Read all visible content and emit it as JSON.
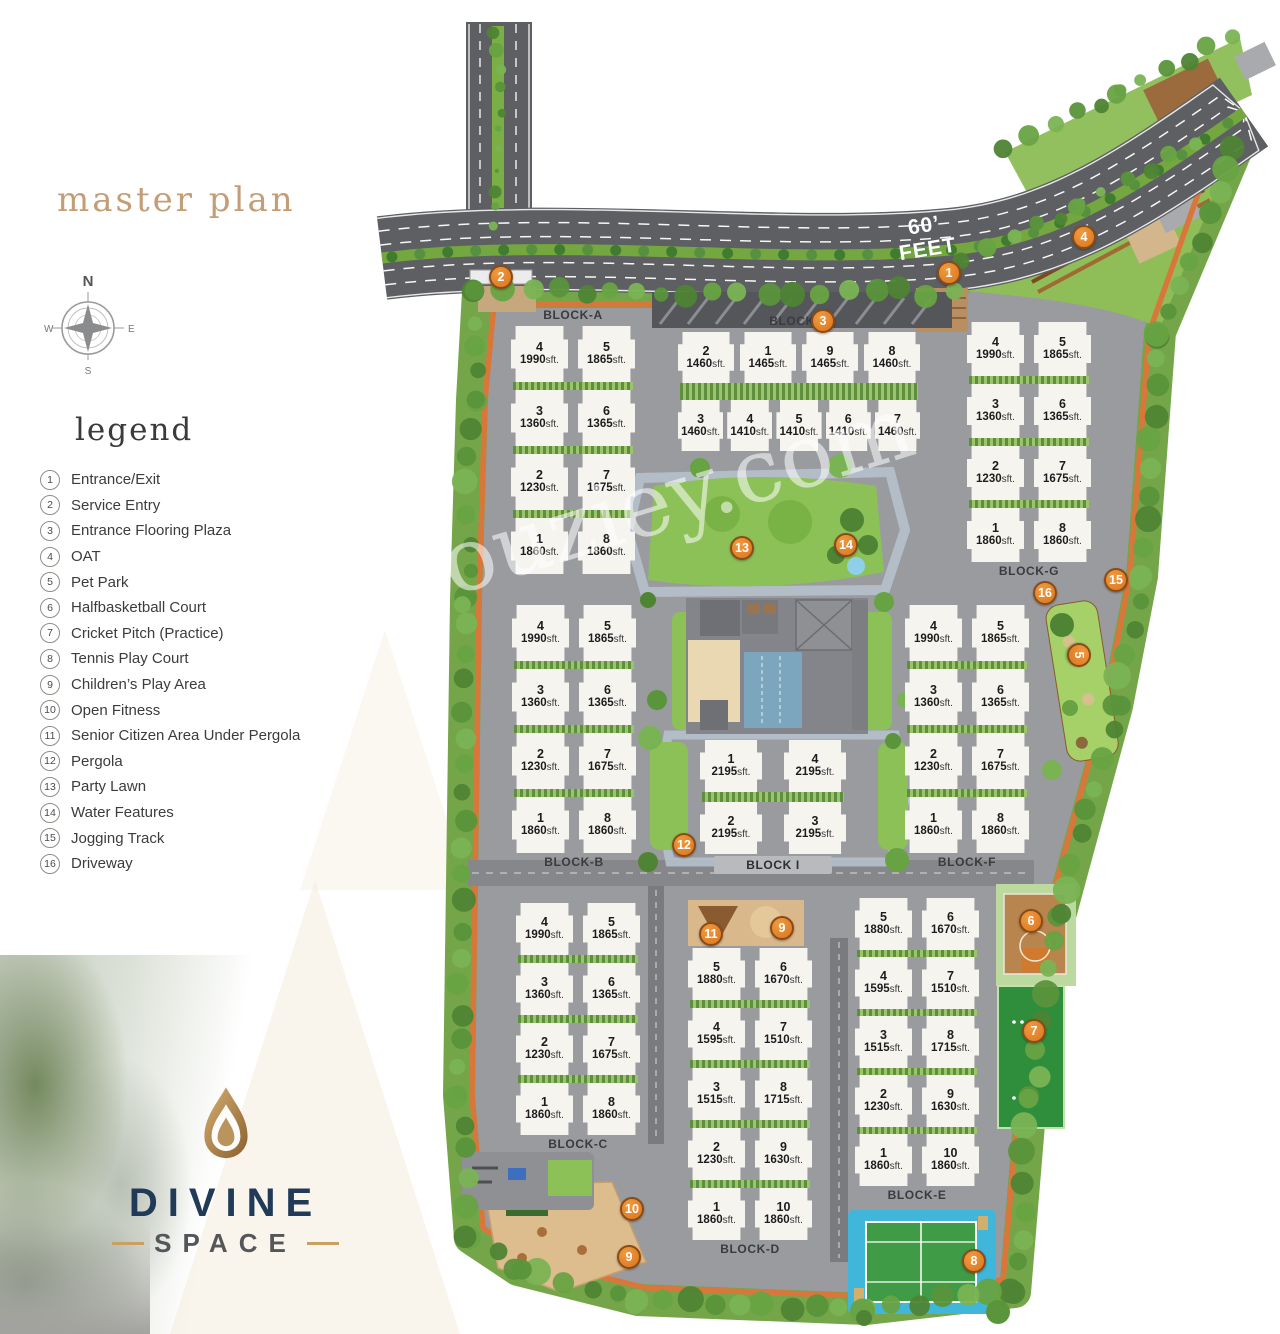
{
  "header": {
    "title": "master plan",
    "legend_title": "legend"
  },
  "compass": {
    "north": "N",
    "east": "E",
    "south": "S",
    "west": "W"
  },
  "legend": {
    "items": [
      {
        "num": "1",
        "label": "Entrance/Exit"
      },
      {
        "num": "2",
        "label": "Service Entry"
      },
      {
        "num": "3",
        "label": "Entrance Flooring Plaza"
      },
      {
        "num": "4",
        "label": "OAT"
      },
      {
        "num": "5",
        "label": "Pet Park"
      },
      {
        "num": "6",
        "label": "Halfbasketball Court"
      },
      {
        "num": "7",
        "label": "Cricket Pitch (Practice)"
      },
      {
        "num": "8",
        "label": "Tennis Play Court"
      },
      {
        "num": "9",
        "label": "Children’s Play Area"
      },
      {
        "num": "10",
        "label": "Open Fitness"
      },
      {
        "num": "11",
        "label": "Senior Citizen Area Under Pergola"
      },
      {
        "num": "12",
        "label": "Pergola"
      },
      {
        "num": "13",
        "label": "Party Lawn"
      },
      {
        "num": "14",
        "label": "Water Features"
      },
      {
        "num": "15",
        "label": "Jogging Track"
      },
      {
        "num": "16",
        "label": "Driveway"
      }
    ]
  },
  "road": {
    "width_label": "60’",
    "unit_label": "FEET"
  },
  "watermark": "Houziey.com",
  "logo": {
    "line1": "DIVINE",
    "line2": "SPACE"
  },
  "plan": {
    "size_suffix": "sft.",
    "blocks": [
      {
        "name": "BLOCK-A",
        "label_pos": "top",
        "x": 511,
        "y": 326,
        "unit_w": 57,
        "row_h": 56,
        "row_gap": 8,
        "col_gap": 10,
        "rows": [
          [
            {
              "no": "4",
              "size": "1990"
            },
            {
              "no": "5",
              "size": "1865"
            }
          ],
          [
            {
              "no": "3",
              "size": "1360"
            },
            {
              "no": "6",
              "size": "1365"
            }
          ],
          [
            {
              "no": "2",
              "size": "1230"
            },
            {
              "no": "7",
              "size": "1675"
            }
          ],
          [
            {
              "no": "1",
              "size": "1860"
            },
            {
              "no": "8",
              "size": "1860"
            }
          ]
        ]
      },
      {
        "name": "BLOCK-H",
        "label_pos": "top",
        "x": 678,
        "y": 332,
        "unit_w": 56,
        "row_h": 51,
        "row_gap": 17,
        "col_gap": 6,
        "unit_w_rows": [
          56,
          46
        ],
        "col_gaps": [
          6,
          4
        ],
        "rows": [
          [
            {
              "no": "2",
              "size": "1460"
            },
            {
              "no": "1",
              "size": "1465"
            },
            {
              "no": "9",
              "size": "1465"
            },
            {
              "no": "8",
              "size": "1460"
            }
          ],
          [
            {
              "no": "3",
              "size": "1460"
            },
            {
              "no": "4",
              "size": "1410"
            },
            {
              "no": "5",
              "size": "1410"
            },
            {
              "no": "6",
              "size": "1410"
            },
            {
              "no": "7",
              "size": "1460"
            }
          ]
        ]
      },
      {
        "name": "BLOCK-G",
        "label_pos": "bottom",
        "x": 967,
        "y": 322,
        "unit_w": 57,
        "row_h": 54,
        "row_gap": 8,
        "col_gap": 10,
        "rows": [
          [
            {
              "no": "4",
              "size": "1990"
            },
            {
              "no": "5",
              "size": "1865"
            }
          ],
          [
            {
              "no": "3",
              "size": "1360"
            },
            {
              "no": "6",
              "size": "1365"
            }
          ],
          [
            {
              "no": "2",
              "size": "1230"
            },
            {
              "no": "7",
              "size": "1675"
            }
          ],
          [
            {
              "no": "1",
              "size": "1860"
            },
            {
              "no": "8",
              "size": "1860"
            }
          ]
        ]
      },
      {
        "name": "BLOCK-B",
        "label_pos": "bottom",
        "x": 512,
        "y": 605,
        "unit_w": 57,
        "row_h": 56,
        "row_gap": 8,
        "col_gap": 10,
        "rows": [
          [
            {
              "no": "4",
              "size": "1990"
            },
            {
              "no": "5",
              "size": "1865"
            }
          ],
          [
            {
              "no": "3",
              "size": "1360"
            },
            {
              "no": "6",
              "size": "1365"
            }
          ],
          [
            {
              "no": "2",
              "size": "1230"
            },
            {
              "no": "7",
              "size": "1675"
            }
          ],
          [
            {
              "no": "1",
              "size": "1860"
            },
            {
              "no": "8",
              "size": "1860"
            }
          ]
        ]
      },
      {
        "name": "BLOCK-F",
        "label_pos": "bottom",
        "x": 905,
        "y": 605,
        "unit_w": 57,
        "row_h": 56,
        "row_gap": 8,
        "col_gap": 10,
        "rows": [
          [
            {
              "no": "4",
              "size": "1990"
            },
            {
              "no": "5",
              "size": "1865"
            }
          ],
          [
            {
              "no": "3",
              "size": "1360"
            },
            {
              "no": "6",
              "size": "1365"
            }
          ],
          [
            {
              "no": "2",
              "size": "1230"
            },
            {
              "no": "7",
              "size": "1675"
            }
          ],
          [
            {
              "no": "1",
              "size": "1860"
            },
            {
              "no": "8",
              "size": "1860"
            }
          ]
        ]
      },
      {
        "name": "BLOCK I",
        "label_pos": "bottom",
        "chip": true,
        "x": 700,
        "y": 740,
        "unit_w": 62,
        "row_h": 52,
        "row_gap": 10,
        "col_gap": 22,
        "rows": [
          [
            {
              "no": "1",
              "size": "2195"
            },
            {
              "no": "4",
              "size": "2195"
            }
          ],
          [
            {
              "no": "2",
              "size": "2195"
            },
            {
              "no": "3",
              "size": "2195"
            }
          ]
        ]
      },
      {
        "name": "BLOCK-C",
        "label_pos": "bottom",
        "x": 516,
        "y": 903,
        "unit_w": 57,
        "row_h": 52,
        "row_gap": 8,
        "col_gap": 10,
        "rows": [
          [
            {
              "no": "4",
              "size": "1990"
            },
            {
              "no": "5",
              "size": "1865"
            }
          ],
          [
            {
              "no": "3",
              "size": "1360"
            },
            {
              "no": "6",
              "size": "1365"
            }
          ],
          [
            {
              "no": "2",
              "size": "1230"
            },
            {
              "no": "7",
              "size": "1675"
            }
          ],
          [
            {
              "no": "1",
              "size": "1860"
            },
            {
              "no": "8",
              "size": "1860"
            }
          ]
        ]
      },
      {
        "name": "BLOCK-D",
        "label_pos": "bottom",
        "x": 688,
        "y": 948,
        "unit_w": 57,
        "row_h": 52,
        "row_gap": 8,
        "col_gap": 10,
        "rows": [
          [
            {
              "no": "5",
              "size": "1880"
            },
            {
              "no": "6",
              "size": "1670"
            }
          ],
          [
            {
              "no": "4",
              "size": "1595"
            },
            {
              "no": "7",
              "size": "1510"
            }
          ],
          [
            {
              "no": "3",
              "size": "1515"
            },
            {
              "no": "8",
              "size": "1715"
            }
          ],
          [
            {
              "no": "2",
              "size": "1230"
            },
            {
              "no": "9",
              "size": "1630"
            }
          ],
          [
            {
              "no": "1",
              "size": "1860"
            },
            {
              "no": "10",
              "size": "1860"
            }
          ]
        ]
      },
      {
        "name": "BLOCK-E",
        "label_pos": "bottom",
        "x": 855,
        "y": 898,
        "unit_w": 57,
        "row_h": 52,
        "row_gap": 7,
        "col_gap": 10,
        "rows": [
          [
            {
              "no": "5",
              "size": "1880"
            },
            {
              "no": "6",
              "size": "1670"
            }
          ],
          [
            {
              "no": "4",
              "size": "1595"
            },
            {
              "no": "7",
              "size": "1510"
            }
          ],
          [
            {
              "no": "3",
              "size": "1515"
            },
            {
              "no": "8",
              "size": "1715"
            }
          ],
          [
            {
              "no": "2",
              "size": "1230"
            },
            {
              "no": "9",
              "size": "1630"
            }
          ],
          [
            {
              "no": "1",
              "size": "1860"
            },
            {
              "no": "10",
              "size": "1860"
            }
          ]
        ]
      }
    ],
    "markers": [
      {
        "no": "1",
        "x": 949,
        "y": 273
      },
      {
        "no": "2",
        "x": 501,
        "y": 277
      },
      {
        "no": "3",
        "x": 823,
        "y": 321
      },
      {
        "no": "4",
        "x": 1084,
        "y": 237
      },
      {
        "no": "5",
        "x": 1079,
        "y": 655,
        "rot": 90
      },
      {
        "no": "6",
        "x": 1031,
        "y": 921
      },
      {
        "no": "7",
        "x": 1034,
        "y": 1031
      },
      {
        "no": "8",
        "x": 974,
        "y": 1261
      },
      {
        "no": "9",
        "x": 782,
        "y": 928
      },
      {
        "no": "9",
        "x": 629,
        "y": 1257
      },
      {
        "no": "10",
        "x": 632,
        "y": 1209
      },
      {
        "no": "11",
        "x": 711,
        "y": 934
      },
      {
        "no": "12",
        "x": 684,
        "y": 845
      },
      {
        "no": "13",
        "x": 742,
        "y": 548
      },
      {
        "no": "14",
        "x": 846,
        "y": 545
      },
      {
        "no": "15",
        "x": 1116,
        "y": 580
      },
      {
        "no": "16",
        "x": 1045,
        "y": 593
      }
    ]
  }
}
